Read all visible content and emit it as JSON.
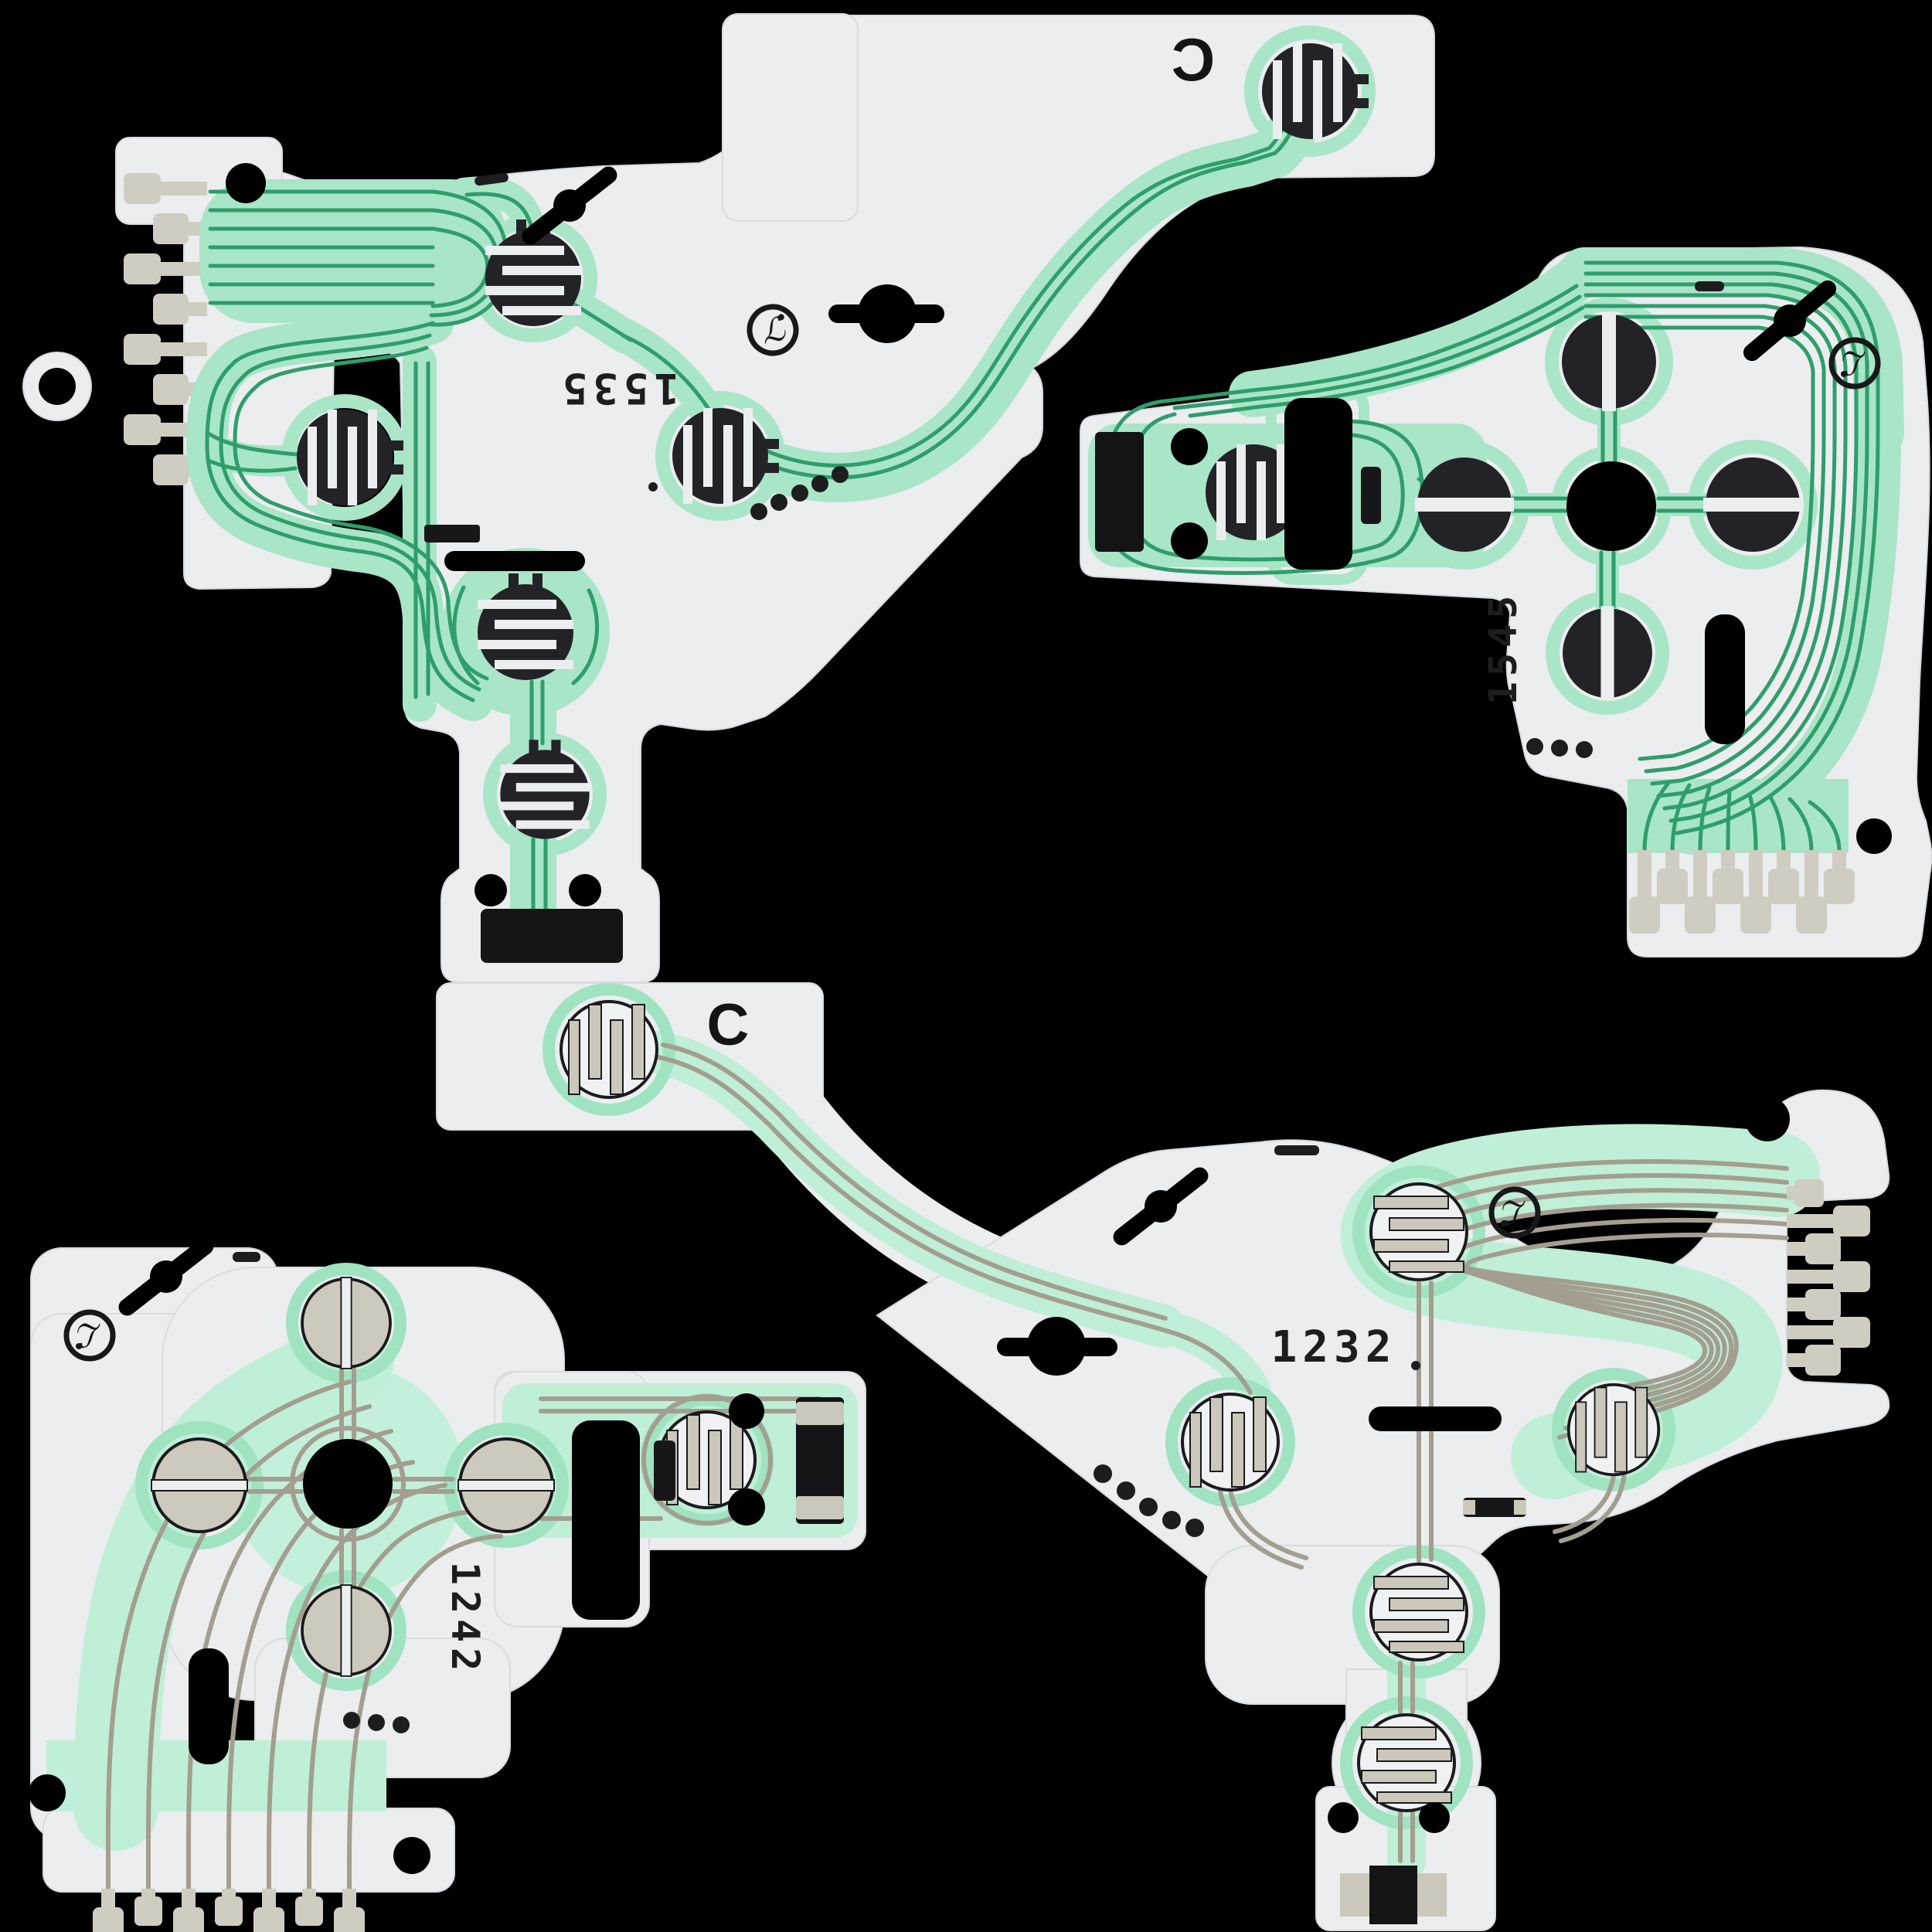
{
  "scene": {
    "type": "product-photo",
    "background": "#000000",
    "subject": "Four conductive-film flex circuits (controller button membranes) on black background"
  },
  "colors": {
    "film": "#ECEDEF",
    "film_edge": "#D9DBDF",
    "pale_green": "#A9E5C7",
    "trace_green": "#2E9E6B",
    "mint_field": "#BFEFD7",
    "mint_halo": "#9FE3C1",
    "carbon": "#232327",
    "silver": "#CBC7BA",
    "silver_trace": "#A39E8F",
    "ink": "#1D1D1F"
  },
  "logo": {
    "glyph": "ℒ",
    "name": "manufacturer-mark"
  },
  "pieces": [
    {
      "id": "top-left",
      "name": "action-button-film-front",
      "batch_code": "1535",
      "batch_code_rotation_deg": 180,
      "strip_letter": "C",
      "strip_letter_mirrored": true,
      "contact_pads": 6,
      "connector_fingers": 8,
      "index_dots": 5
    },
    {
      "id": "top-right",
      "name": "dpad-film-front",
      "batch_code": "1545",
      "batch_code_rotation_deg": -90,
      "contact_pads": 5,
      "connector_fingers": 8,
      "index_dots": 3
    },
    {
      "id": "bottom-left",
      "name": "dpad-film-back",
      "batch_code": "1242",
      "batch_code_rotation_deg": 90,
      "contact_pads": 5,
      "connector_fingers": 7,
      "index_dots": 3
    },
    {
      "id": "bottom-right",
      "name": "action-button-film-back",
      "batch_code": "1232",
      "batch_code_rotation_deg": 0,
      "strip_letter": "C",
      "strip_letter_mirrored": false,
      "contact_pads": 6,
      "connector_fingers": 7,
      "index_dots": 5
    }
  ]
}
